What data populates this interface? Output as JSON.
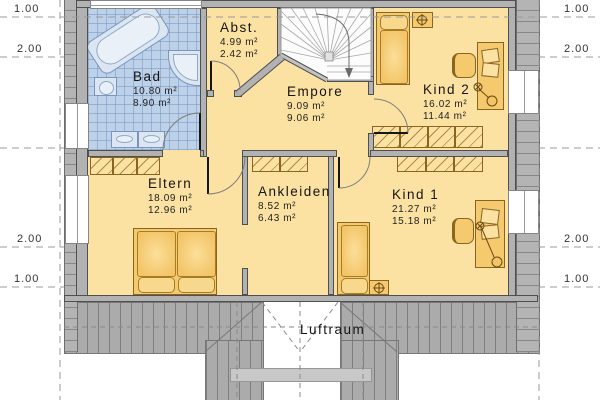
{
  "rooms": [
    {
      "name": "Bad",
      "area1": "10.80 m²",
      "area2": "8.90 m²"
    },
    {
      "name": "Abst.",
      "area1": "4.99 m²",
      "area2": "2.42 m²"
    },
    {
      "name": "Empore",
      "area1": "9.09 m²",
      "area2": "9.06 m²"
    },
    {
      "name": "Kind 2",
      "area1": "16.02 m²",
      "area2": "11.44 m²"
    },
    {
      "name": "Eltern",
      "area1": "18.09 m²",
      "area2": "12.96 m²"
    },
    {
      "name": "Ankleiden",
      "area1": "8.52 m²",
      "area2": "6.43 m²"
    },
    {
      "name": "Kind 1",
      "area1": "21.27 m²",
      "area2": "15.18 m²"
    }
  ],
  "void_label": "Luftraum",
  "dims": {
    "left": [
      "1.00",
      "2.00",
      "2.00",
      "1.00"
    ],
    "right": [
      "1.00",
      "2.00",
      "2.00",
      "1.00"
    ]
  },
  "colors": {
    "room": "#fbe2a2",
    "bath_tile": "#bdd1e8",
    "wall": "#b2b2b2",
    "roof": "#ababab",
    "furniture": "#f5c96e",
    "fixture": "#dce6f3"
  },
  "furniture_items": [
    "staircase",
    "corner-bathtub",
    "corner-shower",
    "wc",
    "double-washbasin",
    "double-bed",
    "single-bed",
    "nightstand",
    "wardrobe",
    "desk",
    "desk-chair",
    "desk-lamp"
  ]
}
